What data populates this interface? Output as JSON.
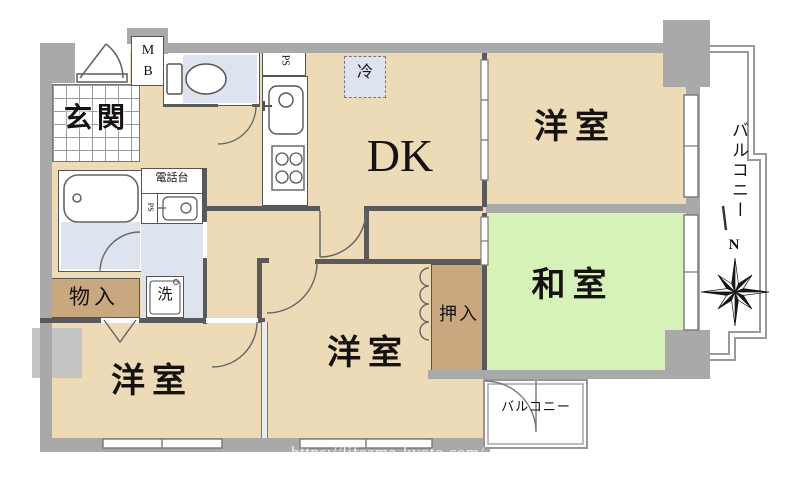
{
  "rooms": {
    "entrance": "玄関",
    "dining_kitchen": "DK",
    "western_room_top": "洋室",
    "western_room_center": "洋室",
    "western_room_left": "洋室",
    "japanese_room": "和室",
    "closet_oshiire": "押入",
    "closet_storage": "物入",
    "balcony_right": "バルコニー",
    "balcony_bottom": "バルコニー"
  },
  "fixtures": {
    "meter_box": "M B",
    "pipe_space_kitchen": "PS",
    "pipe_space_utility": "PS",
    "refrigerator": "冷",
    "phone_stand": "電話台",
    "washer": "洗"
  },
  "compass": {
    "north_label": "N"
  },
  "watermark": "https://lifeama-kyoto.com/",
  "colors": {
    "wall": "#a9a9a9",
    "floor": "#eddbb8",
    "tatami": "#d6f2b8",
    "closet": "#c9a87f",
    "water": "#dde3ef",
    "line": "#5a5a5a"
  }
}
